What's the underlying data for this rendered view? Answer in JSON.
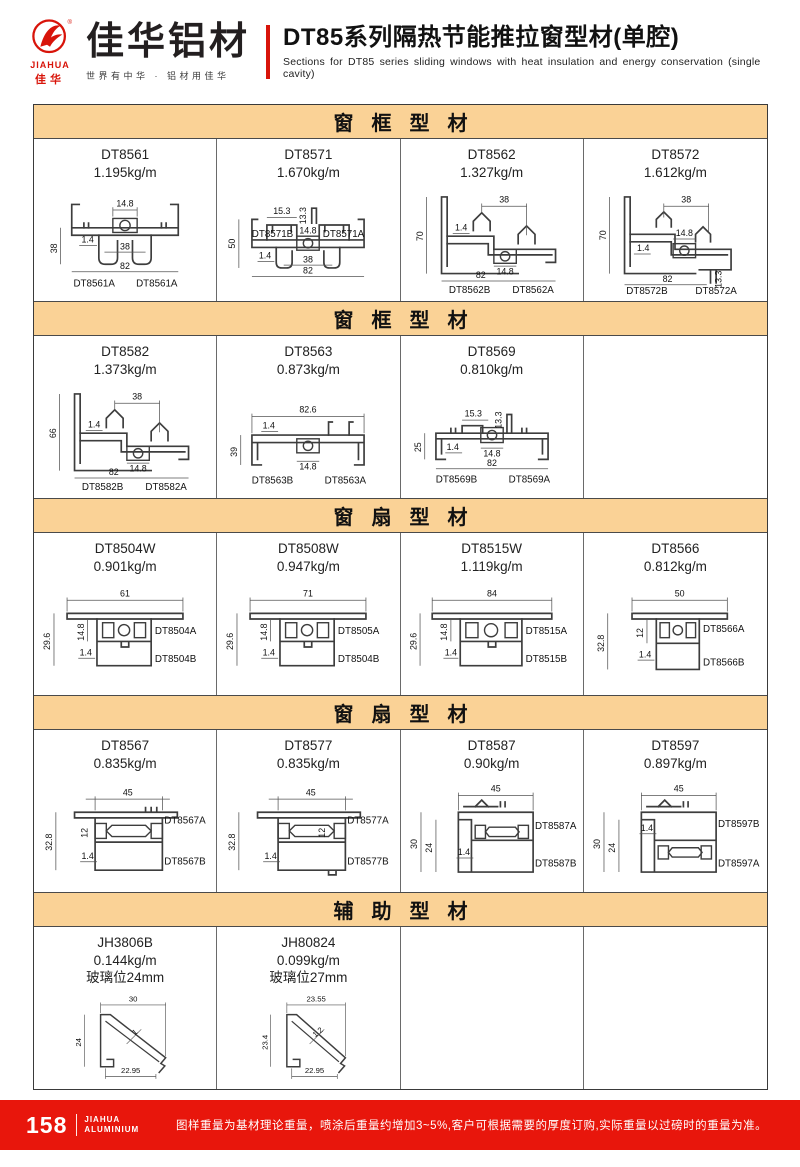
{
  "header": {
    "logo": {
      "brand_en": "JIAHUA",
      "brand_cn": "佳华",
      "name": "佳华铝材",
      "tagline": "世界有中华 · 铝材用佳华"
    },
    "title_cn": "DT85系列隔热节能推拉窗型材(单腔)",
    "title_en": "Sections for DT85 series sliding windows with heat insulation and energy conservation (single cavity)"
  },
  "sections": [
    {
      "title": "窗框型材",
      "cells": [
        {
          "code": "DT8561",
          "weight": "1.195kg/m",
          "dims": [
            "14.8",
            "38",
            "1.4",
            "38",
            "82"
          ],
          "parts": [
            "DT8561A",
            "DT8561A"
          ]
        },
        {
          "code": "DT8571",
          "weight": "1.670kg/m",
          "dims": [
            "15.3",
            "13.3",
            "14.8",
            "50",
            "1.4",
            "38",
            "82"
          ],
          "parts": [
            "DT8571B",
            "DT8571A"
          ]
        },
        {
          "code": "DT8562",
          "weight": "1.327kg/m",
          "dims": [
            "38",
            "70",
            "1.4",
            "14.8",
            "82"
          ],
          "parts": [
            "DT8562B",
            "DT8562A"
          ]
        },
        {
          "code": "DT8572",
          "weight": "1.612kg/m",
          "dims": [
            "38",
            "70",
            "14.8",
            "1.4",
            "82",
            "13.3"
          ],
          "parts": [
            "DT8572B",
            "DT8572A"
          ]
        }
      ]
    },
    {
      "title": "窗框型材",
      "cells": [
        {
          "code": "DT8582",
          "weight": "1.373kg/m",
          "dims": [
            "38",
            "66",
            "1.4",
            "14.8",
            "82"
          ],
          "parts": [
            "DT8582B",
            "DT8582A"
          ]
        },
        {
          "code": "DT8563",
          "weight": "0.873kg/m",
          "dims": [
            "82.6",
            "1.4",
            "39",
            "14.8"
          ],
          "parts": [
            "DT8563B",
            "DT8563A"
          ]
        },
        {
          "code": "DT8569",
          "weight": "0.810kg/m",
          "dims": [
            "15.3",
            "13.3",
            "25",
            "1.4",
            "14.8",
            "82"
          ],
          "parts": [
            "DT8569B",
            "DT8569A"
          ]
        },
        null
      ]
    },
    {
      "title": "窗扇型材",
      "cells": [
        {
          "code": "DT8504W",
          "weight": "0.901kg/m",
          "dims": [
            "61",
            "29.6",
            "14.8",
            "1.4"
          ],
          "parts": [
            "DT8504A",
            "DT8504B"
          ]
        },
        {
          "code": "DT8508W",
          "weight": "0.947kg/m",
          "dims": [
            "71",
            "29.6",
            "14.8",
            "1.4"
          ],
          "parts": [
            "DT8505A",
            "DT8504B"
          ]
        },
        {
          "code": "DT8515W",
          "weight": "1.119kg/m",
          "dims": [
            "84",
            "29.6",
            "14.8",
            "1.4"
          ],
          "parts": [
            "DT8515A",
            "DT8515B"
          ]
        },
        {
          "code": "DT8566",
          "weight": "0.812kg/m",
          "dims": [
            "50",
            "32.8",
            "12",
            "1.4"
          ],
          "parts": [
            "DT8566A",
            "DT8566B"
          ]
        }
      ]
    },
    {
      "title": "窗扇型材",
      "cells": [
        {
          "code": "DT8567",
          "weight": "0.835kg/m",
          "dims": [
            "45",
            "32.8",
            "12",
            "1.4"
          ],
          "parts": [
            "DT8567A",
            "DT8567B"
          ]
        },
        {
          "code": "DT8577",
          "weight": "0.835kg/m",
          "dims": [
            "45",
            "32.8",
            "12",
            "1.4"
          ],
          "parts": [
            "DT8577A",
            "DT8577B"
          ]
        },
        {
          "code": "DT8587",
          "weight": "0.90kg/m",
          "dims": [
            "45",
            "30",
            "24",
            "1.4"
          ],
          "parts": [
            "DT8587A",
            "DT8587B"
          ]
        },
        {
          "code": "DT8597",
          "weight": "0.897kg/m",
          "dims": [
            "45",
            "30",
            "24",
            "1.4"
          ],
          "parts": [
            "DT8597B",
            "DT8597A"
          ]
        }
      ]
    },
    {
      "title": "辅助型材",
      "cells": [
        {
          "code": "JH3806B",
          "weight": "0.144kg/m",
          "extra": "玻璃位24mm",
          "dims": [
            "30",
            "24",
            "1",
            "22.95"
          ],
          "parts": []
        },
        {
          "code": "JH80824",
          "weight": "0.099kg/m",
          "extra": "玻璃位27mm",
          "dims": [
            "23.55",
            "23.4",
            "1.2",
            "22.95"
          ],
          "parts": []
        },
        null,
        null
      ]
    }
  ],
  "footer": {
    "page": "158",
    "brand_top": "JIAHUA",
    "brand_bottom": "ALUMINIUM",
    "note": "图样重量为基材理论重量，喷涂后重量约增加3~5%,客户可根据需要的厚度订购,实际重量以过磅时的重量为准。"
  },
  "colors": {
    "accent_red": "#e8160c",
    "band_tan": "#fad296",
    "line": "#3d3d3d"
  }
}
